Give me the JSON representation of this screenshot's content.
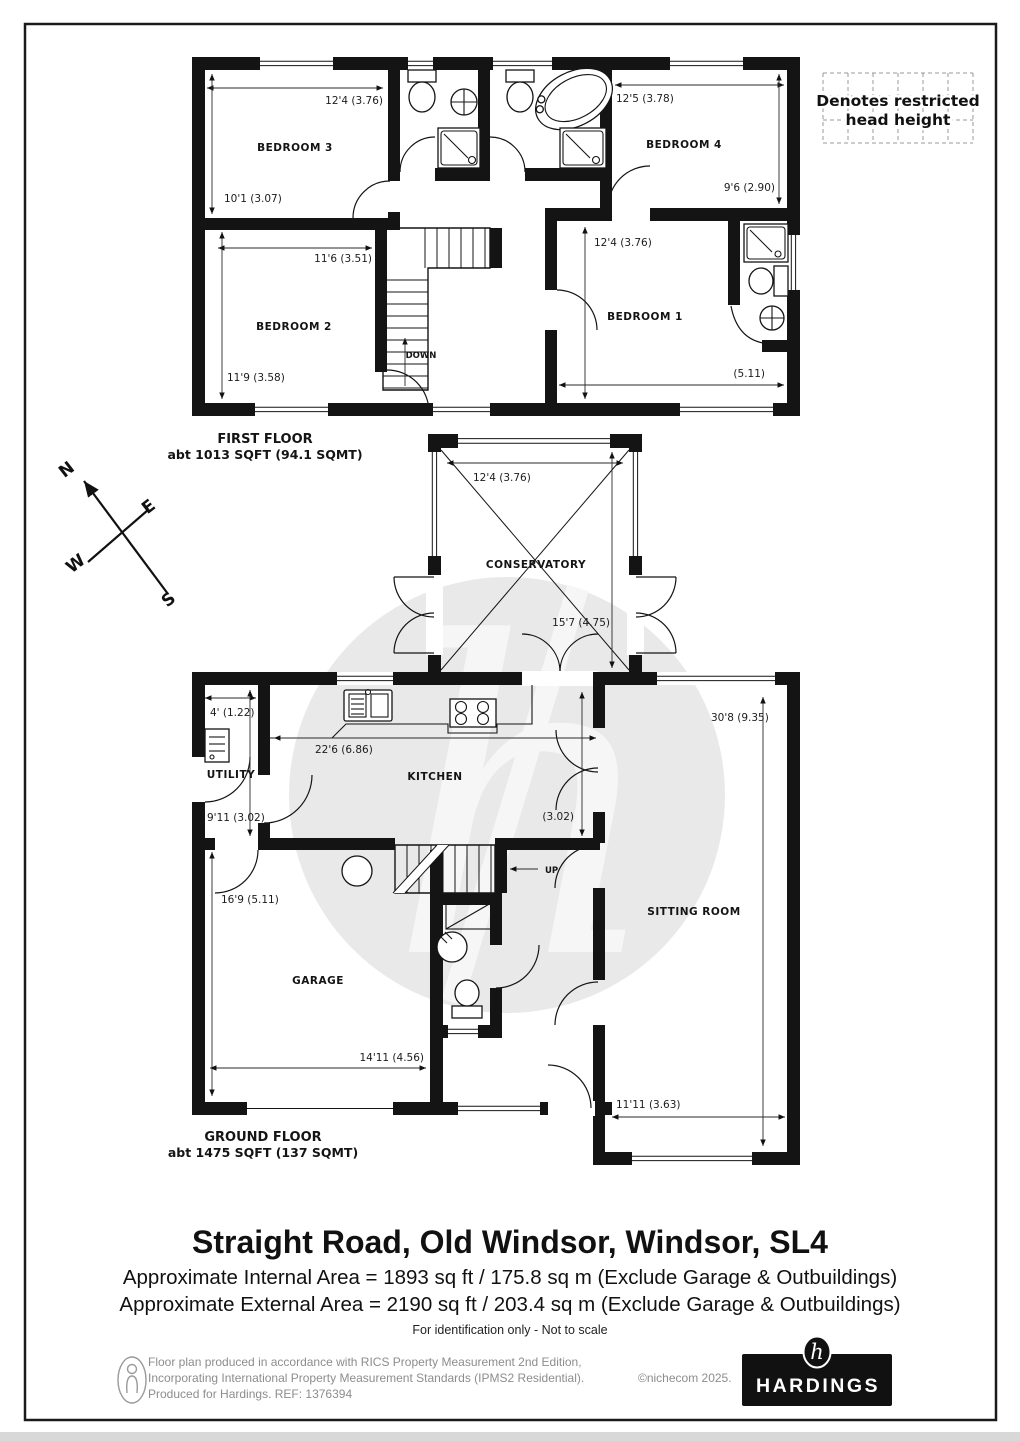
{
  "legend": {
    "line1": "Denotes restricted",
    "line2": "head height"
  },
  "compass": {
    "n": "N",
    "e": "E",
    "s": "S",
    "w": "W"
  },
  "first_floor": {
    "label": "FIRST FLOOR",
    "area": "abt 1013 SQFT (94.1 SQMT)",
    "stairs": "DOWN",
    "bedroom3": {
      "name": "BEDROOM 3",
      "width": "12'4 (3.76)",
      "depth": "10'1 (3.07)"
    },
    "bedroom2": {
      "name": "BEDROOM 2",
      "width": "11'6 (3.51)",
      "depth": "11'9 (3.58)"
    },
    "bedroom4": {
      "name": "BEDROOM 4",
      "width": "12'5 (3.78)",
      "depth": "9'6 (2.90)"
    },
    "bedroom1": {
      "name": "BEDROOM 1",
      "depth": "12'4 (3.76)",
      "width": "(5.11)"
    }
  },
  "ground_floor": {
    "label": "GROUND FLOOR",
    "area": "abt 1475 SQFT (137 SQMT)",
    "stairs": "UP",
    "conservatory": {
      "name": "CONSERVATORY",
      "width": "12'4 (3.76)",
      "depth": "15'7 (4.75)"
    },
    "kitchen": {
      "name": "KITCHEN",
      "width": "22'6 (6.86)",
      "depth": "(3.02)"
    },
    "utility": {
      "name": "UTILITY",
      "width": "4' (1.22)",
      "depth": "9'11 (3.02)"
    },
    "garage": {
      "name": "GARAGE",
      "depth": "16'9 (5.11)",
      "width": "14'11 (4.56)"
    },
    "sitting_room": {
      "name": "SITTING ROOM",
      "depth": "30'8 (9.35)",
      "width": "11'11 (3.63)"
    }
  },
  "title_block": {
    "address": "Straight Road, Old Windsor, Windsor, SL4",
    "internal_area": "Approximate Internal Area = 1893 sq ft / 175.8 sq m (Exclude Garage & Outbuildings)",
    "external_area": "Approximate External Area = 2190 sq ft / 203.4 sq m (Exclude Garage & Outbuildings)",
    "disclaimer": "For identification only - Not to scale"
  },
  "footer": {
    "line1": "Floor plan produced in accordance with RICS Property Measurement 2nd Edition,",
    "line2": "Incorporating International Property Measurement Standards (IPMS2 Residential).",
    "line3": "Produced for Hardings.   REF:   1376394",
    "copyright": "©nichecom 2025.",
    "brand": "HARDINGS",
    "brand_mark": "h"
  }
}
